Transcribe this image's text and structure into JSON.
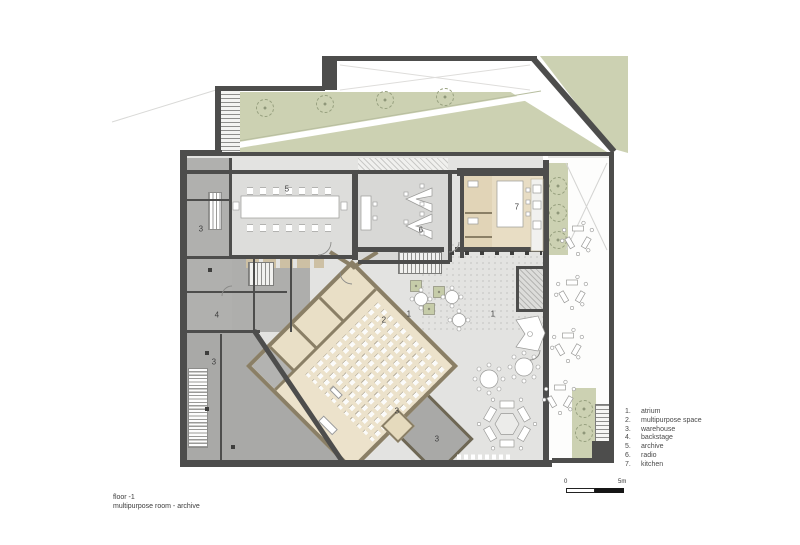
{
  "title_block": {
    "line1": "floor -1",
    "line2": "multipurpose room - archive"
  },
  "legend": {
    "items": [
      {
        "num": "1.",
        "label": "atrium"
      },
      {
        "num": "2.",
        "label": "multipurpose space"
      },
      {
        "num": "3.",
        "label": "warehouse"
      },
      {
        "num": "4.",
        "label": "backstage"
      },
      {
        "num": "5.",
        "label": "archive"
      },
      {
        "num": "6.",
        "label": "radio"
      },
      {
        "num": "7.",
        "label": "kitchen"
      }
    ]
  },
  "scale_bar": {
    "start": "0",
    "end": "5m"
  },
  "plan_labels": [
    {
      "text": "3"
    },
    {
      "text": "5"
    },
    {
      "text": "6"
    },
    {
      "text": "7"
    },
    {
      "text": "4"
    },
    {
      "text": "1"
    },
    {
      "text": "1"
    },
    {
      "text": "2"
    },
    {
      "text": "3"
    },
    {
      "text": "3"
    },
    {
      "text": "3"
    }
  ],
  "colors": {
    "wall_dark": "#4d4d4c",
    "wall_tan": "#8a7f66",
    "floor_light": "#e3e3e1",
    "floor_gray": "#aeaeac",
    "floor_beige": "#ece2cb",
    "kitchen_beige": "#e8ddc4",
    "landscape_green": "#ccd1b2",
    "background": "#ffffff"
  }
}
